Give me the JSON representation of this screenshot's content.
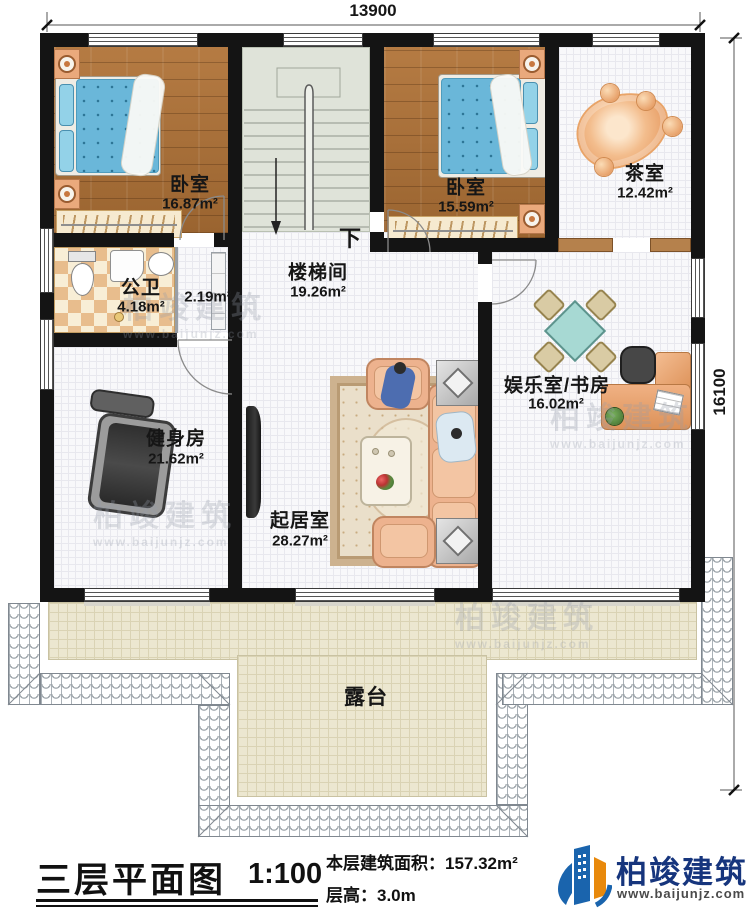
{
  "dimensions": {
    "top": "13900",
    "right": "16100"
  },
  "rooms": {
    "bedroom1": {
      "name": "卧室",
      "area": "16.87m²"
    },
    "bedroom2": {
      "name": "卧室",
      "area": "15.59m²"
    },
    "tea": {
      "name": "茶室",
      "area": "12.42m²"
    },
    "stairhall": {
      "name": "楼梯间",
      "area": "19.26m²",
      "down": "下"
    },
    "bath": {
      "name": "公卫",
      "area": "4.18m²"
    },
    "closet": {
      "area": "2.19m²"
    },
    "gym": {
      "name": "健身房",
      "area": "21.62m²"
    },
    "living": {
      "name": "起居室",
      "area": "28.27m²"
    },
    "study": {
      "name": "娱乐室/书房",
      "area": "16.02m²"
    },
    "terrace": {
      "name": "露台"
    }
  },
  "title": {
    "main": "三层平面图",
    "scale": "1:100",
    "area_line": "本层建筑面积：157.32m²",
    "height_line": "层高：3.0m"
  },
  "logo": {
    "name": "柏竣建筑",
    "url": "www.baijunjz.com"
  },
  "watermark": {
    "text": "柏竣建筑",
    "sub": "www.baijunjz.com"
  },
  "colors": {
    "logo_blue": "#1a64ad",
    "logo_orange": "#e8890c",
    "logo_text": "#16357d",
    "wall": "#141414",
    "terrace": "#ece7d0",
    "wood": "#a8703a"
  }
}
